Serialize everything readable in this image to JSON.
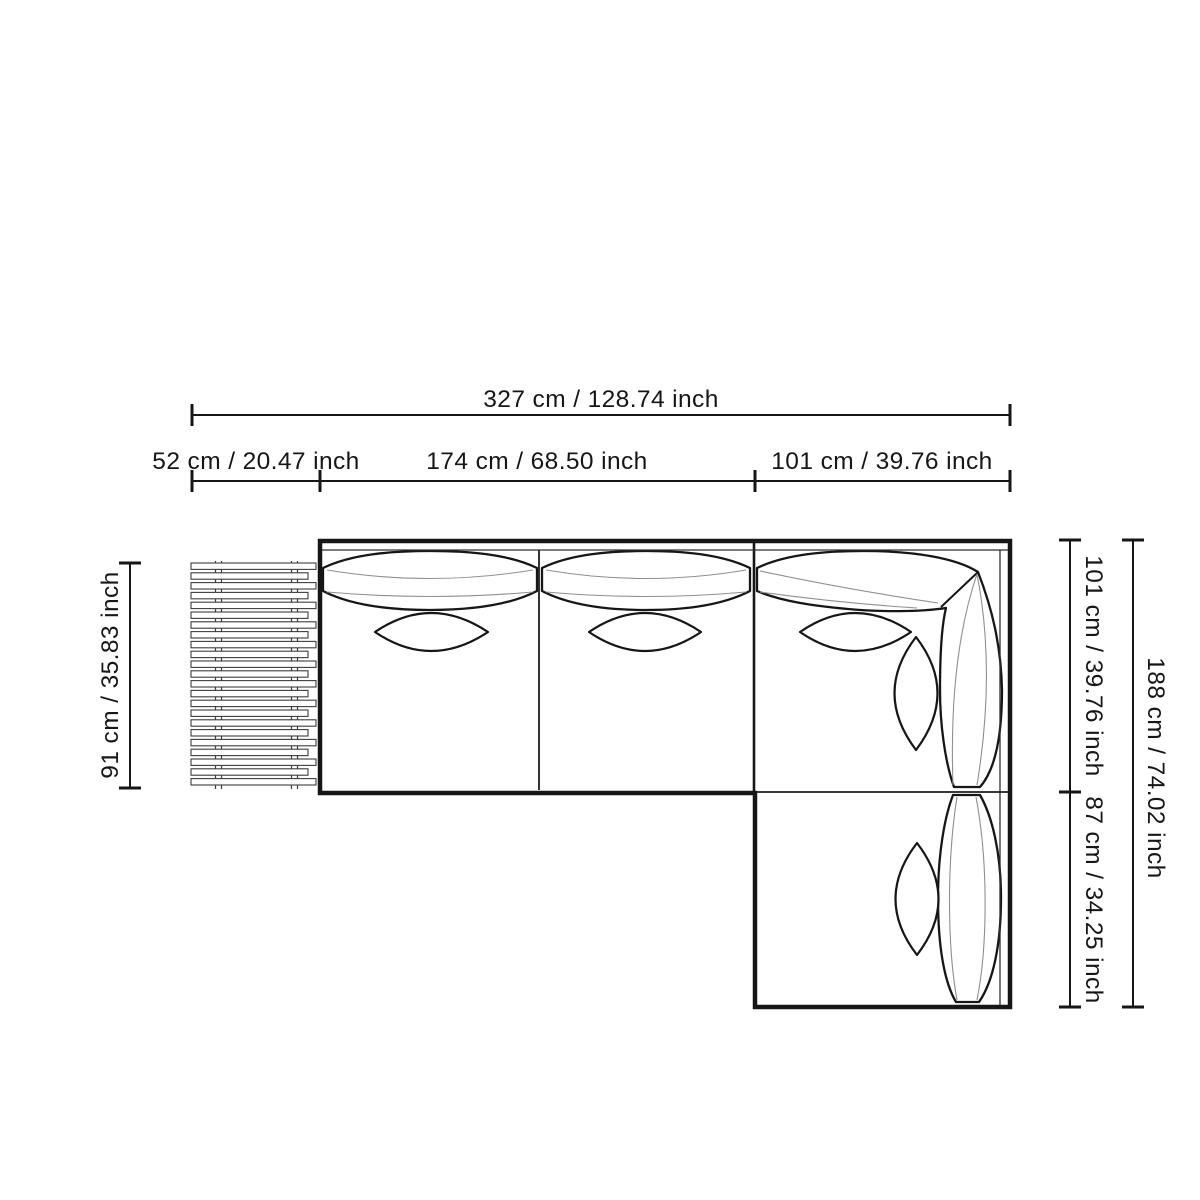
{
  "page": {
    "background": "#ffffff"
  },
  "diagram": {
    "title": "Sectional sofa with chaise and slatted side table — top view dimension drawing",
    "colors": {
      "line": "#161616",
      "seam": "#8f8f8f",
      "background": "#ffffff"
    },
    "dimensions": {
      "overall_width": "327 cm / 128.74 inch",
      "side_table_width": "52 cm / 20.47 inch",
      "seat_section_width": "174 cm / 68.50 inch",
      "corner_section_width": "101 cm / 39.76 inch",
      "side_table_depth": "91 cm / 35.83 inch",
      "sofa_depth": "101 cm / 39.76 inch",
      "chaise_extension_depth": "87 cm / 34.25 inch",
      "overall_depth": "188 cm / 74.02 inch"
    },
    "slats": {
      "count": 23
    }
  }
}
